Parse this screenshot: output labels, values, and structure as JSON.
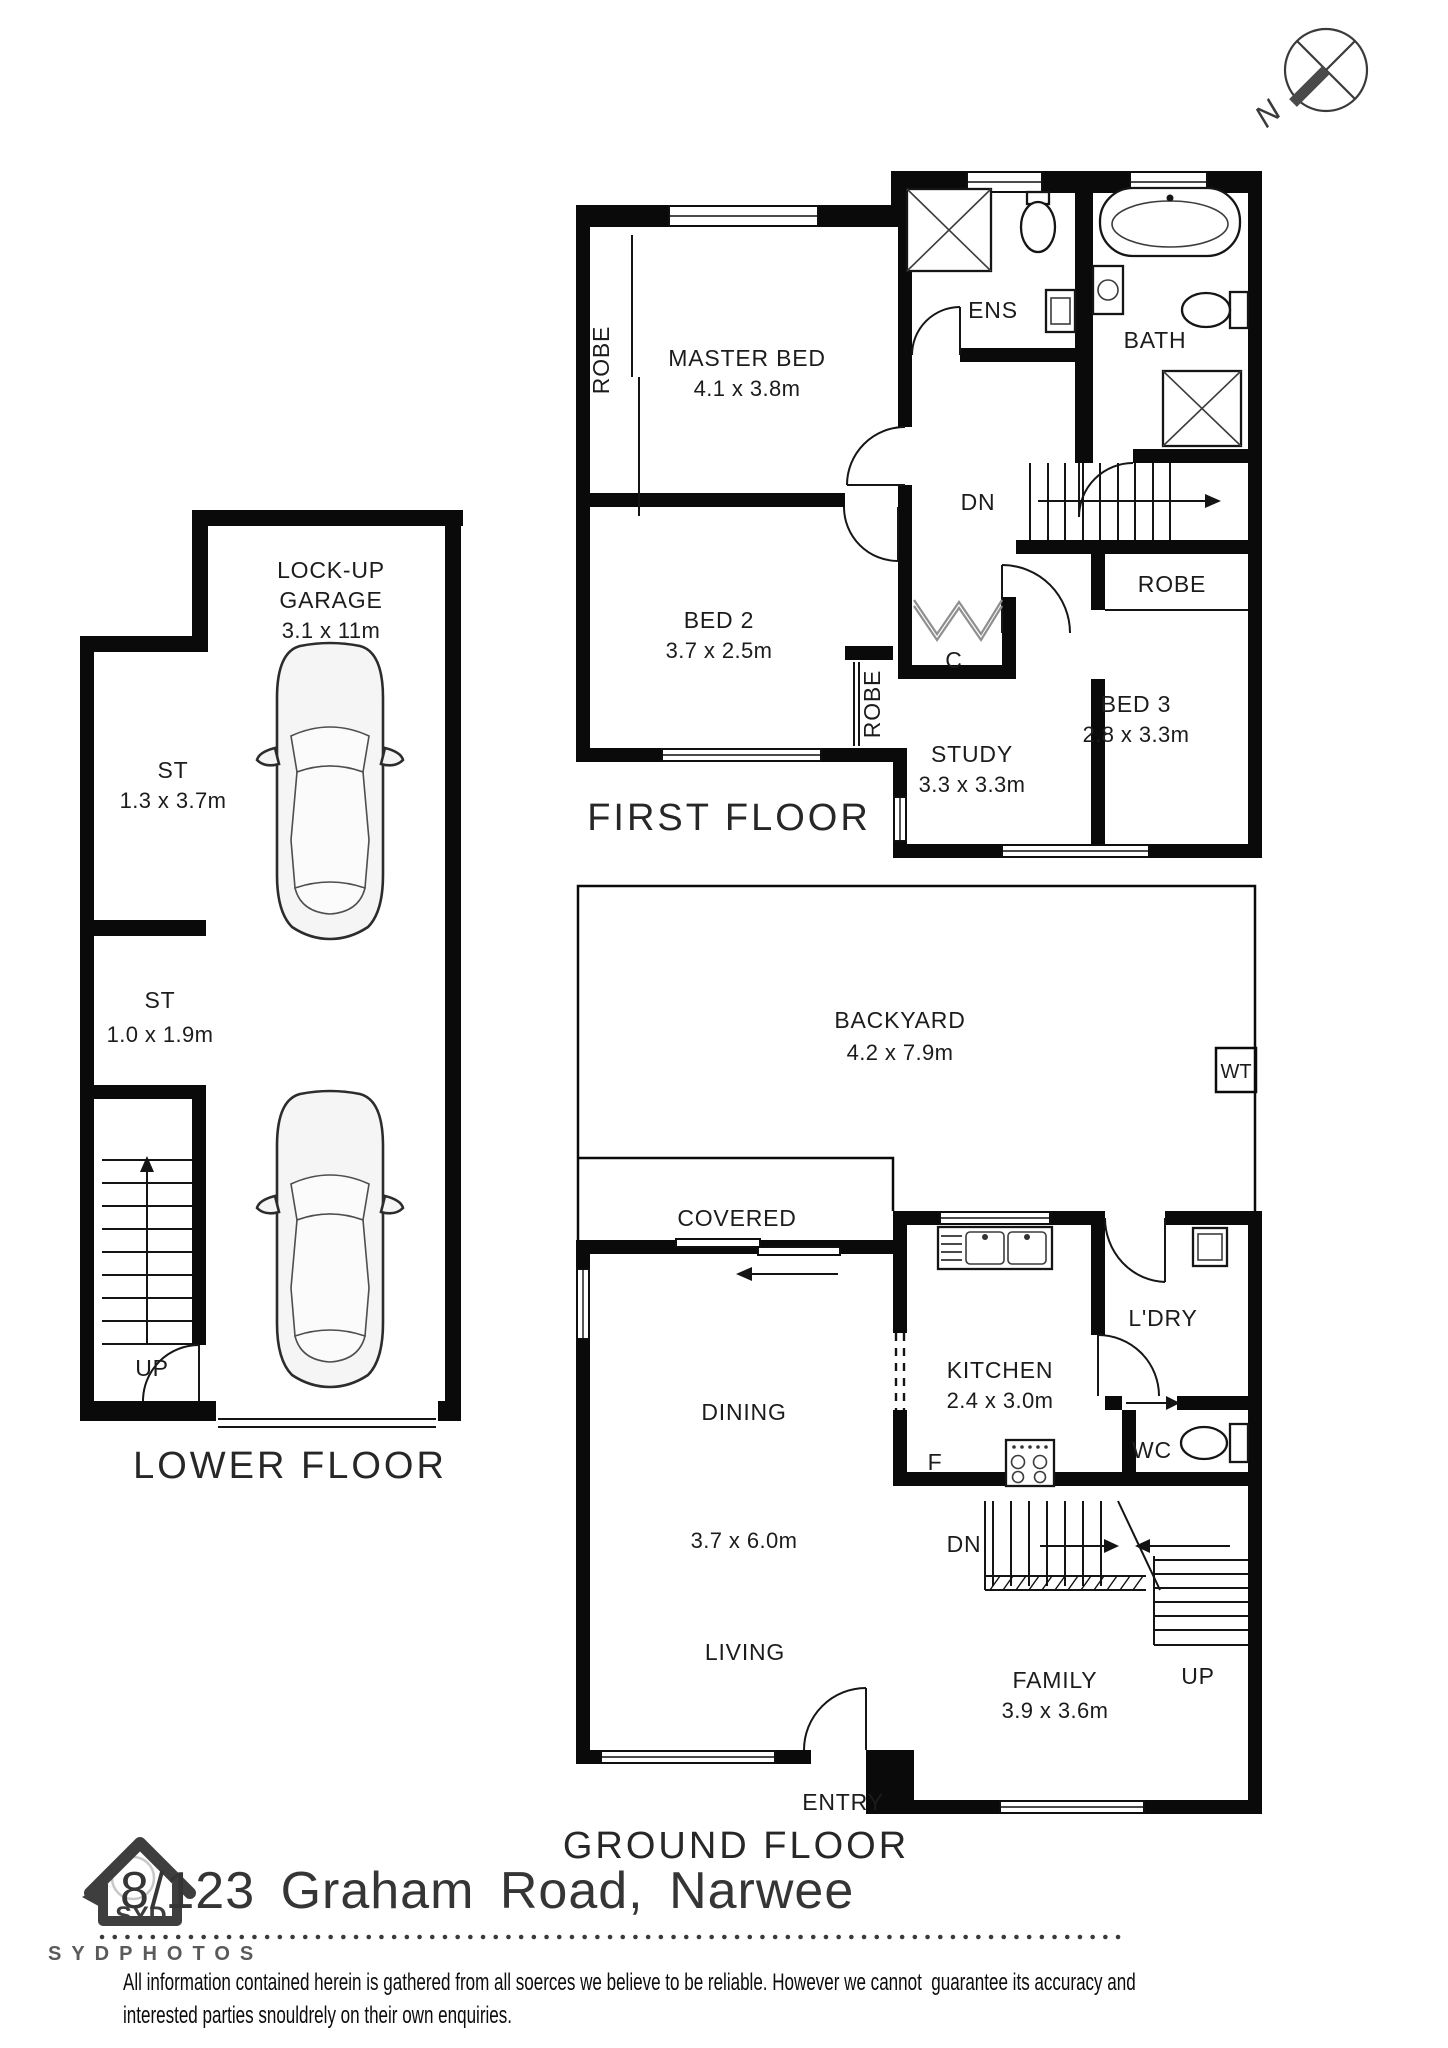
{
  "compass": {
    "north": "N"
  },
  "first_floor": {
    "title": "FIRST FLOOR",
    "master": {
      "name": "MASTER BED",
      "dims": "4.1 x 3.8m"
    },
    "master_robe": "ROBE",
    "ens": "ENS",
    "bath": "BATH",
    "stairs_down": "DN",
    "bed3_robe": "ROBE",
    "bed2": {
      "name": "BED 2",
      "dims": "3.7 x 2.5m"
    },
    "bed2_robe": "ROBE",
    "closet": "C",
    "study": {
      "name": "STUDY",
      "dims": "3.3 x 3.3m"
    },
    "bed3": {
      "name": "BED 3",
      "dims": "2.8 x 3.3m"
    }
  },
  "lower_floor": {
    "title": "LOWER FLOOR",
    "garage": {
      "line1": "LOCK-UP",
      "line2": "GARAGE",
      "dims": "3.1 x 11m"
    },
    "storage1": {
      "name": "ST",
      "dims": "1.3 x 3.7m"
    },
    "storage2": {
      "name": "ST",
      "dims": "1.0 x 1.9m"
    },
    "stairs_up": "UP"
  },
  "ground_floor": {
    "title": "GROUND FLOOR",
    "backyard": {
      "name": "BACKYARD",
      "dims": "4.2 x 7.9m"
    },
    "water_tank": "WT",
    "covered": "COVERED",
    "kitchen": {
      "name": "KITCHEN",
      "dims": "2.4 x 3.0m"
    },
    "laundry": "L'DRY",
    "fridge": "F",
    "wc": "WC",
    "dining": "DINING",
    "living_dining_dims": "3.7 x 6.0m",
    "living": "LIVING",
    "family": {
      "name": "FAMILY",
      "dims": "3.9 x 3.6m"
    },
    "stairs_down": "DN",
    "stairs_up": "UP",
    "entry": "ENTRY"
  },
  "footer": {
    "address": "8/123 Graham Road, Narwee",
    "brand": "SYDPHOTOS",
    "logo_text": "SYD",
    "disclaimer_line1": "All information contained herein is gathered from all soerces we believe to be reliable. However we cannot  guarantee its accuracy and",
    "disclaimer_line2": "interested parties snouldrely on their own enquiries."
  }
}
